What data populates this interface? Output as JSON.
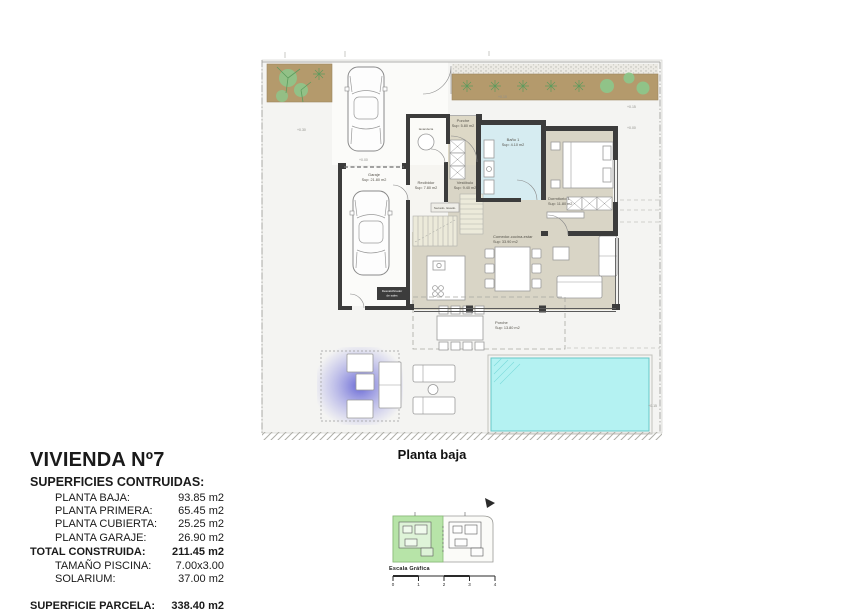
{
  "plan": {
    "caption": "Planta baja",
    "rooms": {
      "garaje": {
        "name": "Garaje",
        "area": "Sup: 21.80 m2"
      },
      "porche_entrada": {
        "name": "Porche",
        "area": "Sup: 5.80 m2"
      },
      "lavanderia": {
        "name": "lavandería"
      },
      "bano1": {
        "name": "Baño 1",
        "area": "Sup: 4.10 m2"
      },
      "dormitorio1": {
        "name": "Dormitorio 1",
        "area": "Sup: 11.80 m2"
      },
      "recibidor": {
        "name": "Recibidor",
        "area": "Sup: 7.80 m2"
      },
      "vestibulo": {
        "name": "Vestíbulo",
        "area": "Sup: 9.40 m2"
      },
      "comedor": {
        "name": "Comedor-cocina-estar",
        "area": "Sup: 33.90 m2"
      },
      "porche_trasero": {
        "name": "Porche",
        "area": "Sup: 13.80 m2"
      },
      "descalcificador_l1": "Descalcificador",
      "descalcificador_l2": "de sales",
      "bench_note": "Secado. lavado."
    },
    "elevations": {
      "e1": "+0.30",
      "e2": "+0.00",
      "e3": "+0.10",
      "e4": "+0.15",
      "e5": "+0.00",
      "e6": "+0.15"
    }
  },
  "title_block": {
    "title": "VIVIENDA Nº7",
    "subtitle": "SUPERFICIES CONTRUIDAS:",
    "rows": [
      {
        "label": "PLANTA BAJA:",
        "value": "93.85 m2"
      },
      {
        "label": "PLANTA PRIMERA:",
        "value": "65.45 m2"
      },
      {
        "label": "PLANTA CUBIERTA:",
        "value": "25.25 m2"
      },
      {
        "label": "PLANTA GARAJE:",
        "value": "26.90 m2"
      }
    ],
    "total": {
      "label": "TOTAL CONSTRUIDA:",
      "value": "211.45 m2"
    },
    "extras": [
      {
        "label": "TAMAÑO PISCINA:",
        "value": "7.00x3.00"
      },
      {
        "label": "SOLARIUM:",
        "value": "37.00 m2"
      }
    ],
    "parcel": {
      "label": "SUPERFICIE PARCELA:",
      "value": "338.40 m2"
    }
  },
  "site_plan": {
    "scale_label": "Escala Gráfica",
    "scale_ticks": [
      "0",
      "1",
      "2",
      "3",
      "4"
    ]
  },
  "colors": {
    "wall": "#3c3c3c",
    "floor_beige": "#d9d5c6",
    "bath_blue": "#d6ecf1",
    "pool": "#b4f2f2",
    "planting_brown": "#b49a6c",
    "plant_green": "#8cc88c",
    "site_green": "#b7e4a8",
    "glow_purple": "#5b5bd6"
  }
}
